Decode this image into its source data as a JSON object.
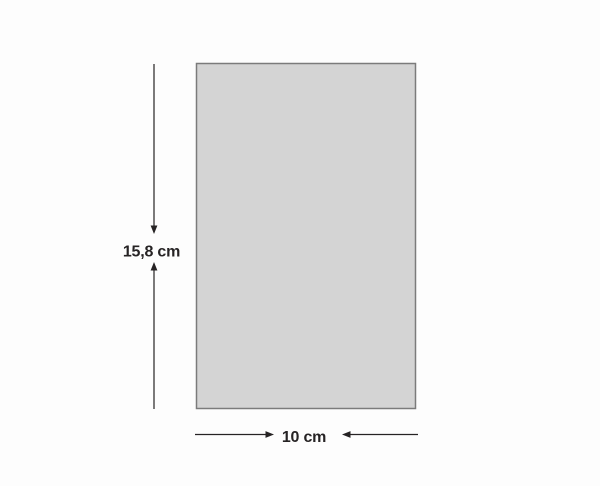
{
  "diagram": {
    "description": "rectangle-with-dimension-annotations",
    "background_color": "#fdfdfd",
    "rectangle": {
      "fill_color": "#d4d4d4",
      "border_color": "#7b7b7b"
    },
    "annotation_color": "#262324",
    "height_dimension": {
      "label": "15,8 cm"
    },
    "width_dimension": {
      "label": "10 cm"
    }
  }
}
